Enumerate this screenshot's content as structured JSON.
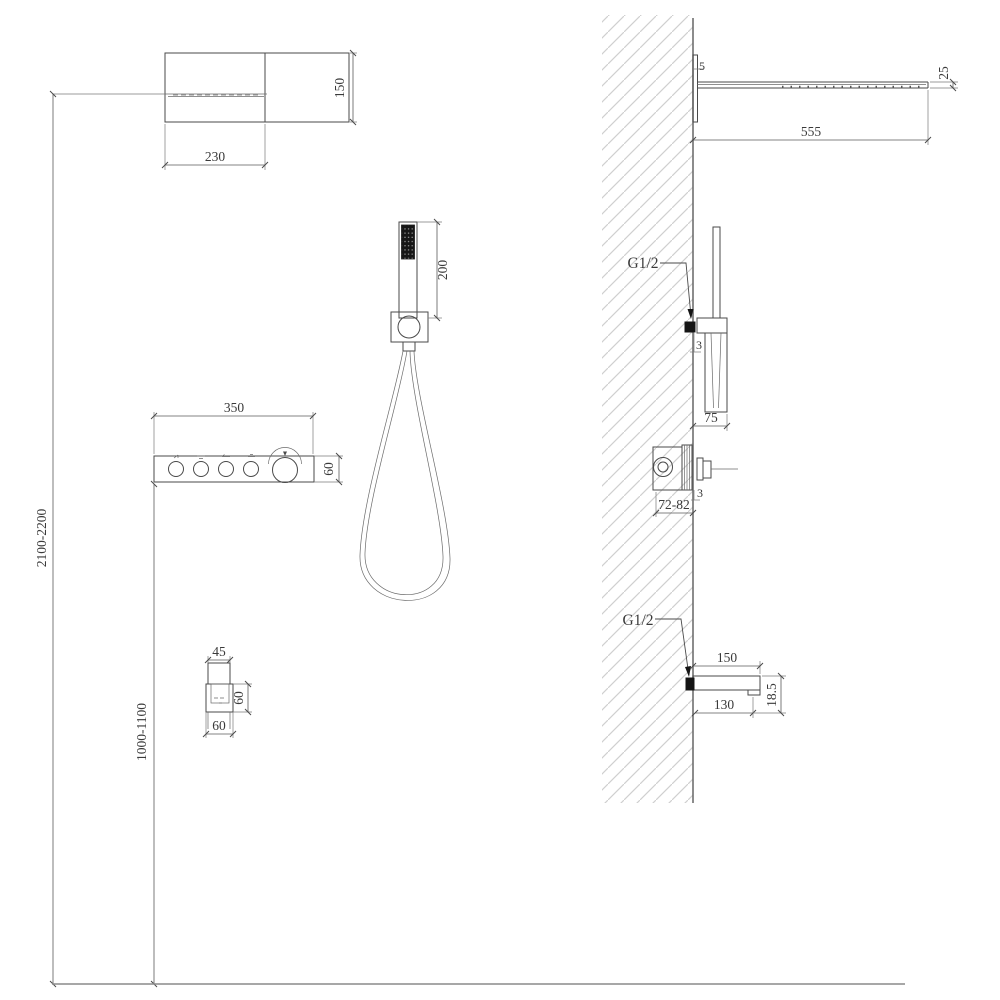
{
  "drawing": {
    "front": {
      "head_width": "230",
      "head_height": "150",
      "hand_shower_length": "200",
      "panel_width": "350",
      "panel_height": "60",
      "mount_height_head": "2100-2200",
      "mount_height_panel": "1000-1100",
      "spout_width": "45",
      "spout_plate_height": "60",
      "spout_plate_width": "60"
    },
    "side": {
      "head_gap": "5",
      "head_thickness": "25",
      "head_projection": "555",
      "hand_shower_connection": "G1/2",
      "hand_shower_offset": "3",
      "hand_shower_projection": "75",
      "valve_offset": "3",
      "valve_depth": "72-82",
      "spout_connection": "G1/2",
      "spout_projection": "150",
      "spout_nozzle_offset": "130",
      "spout_drop": "18.5"
    },
    "colors": {
      "line": "#4a4a4a",
      "hatch": "#cfcfcf",
      "fill_dark": "#141414",
      "background": "#ffffff"
    }
  }
}
